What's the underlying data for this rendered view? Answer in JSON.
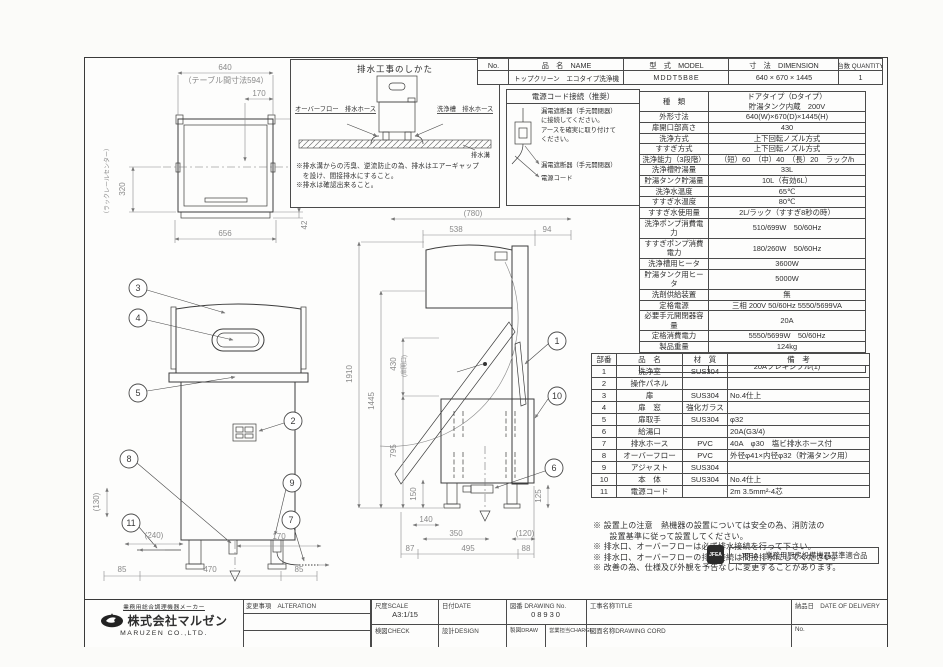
{
  "title_strip": {
    "col_no": "No.",
    "col_name": "品　名　NAME",
    "col_model": "型　式　MODEL",
    "col_dimension": "寸　法　DIMENSION",
    "col_quantity": "台数 QUANTITY",
    "row_no": "",
    "row_name": "トップクリーン　エコタイプ洗浄機",
    "row_model": "MDDT5B8E",
    "row_dimension": "640 × 670 × 1445",
    "row_quantity": "1"
  },
  "drain_box": {
    "title": "排水工事のしかた",
    "label_overflow": "オーバーフロー　排水ホース",
    "label_washtank": "洗浄槽　排水ホース",
    "label_gutter": "排水溝",
    "notes": [
      "※排水溝からの汚臭、逆流防止の為、排水はエアーギャップ",
      "　を設け、間接排水にすること。",
      "※排水は確認出来ること。"
    ]
  },
  "power_box": {
    "title": "電源コード接続（推奨）",
    "body": "漏電遮断器（手元開閉器）\nに接続してください。\nアースを確実に取り付けて\nください。",
    "label_breaker": "漏電遮断器（手元開閉器）",
    "label_cord": "電源コード"
  },
  "spec_table": {
    "rows": [
      [
        "種　類",
        "ドアタイプ（Dタイプ）\n貯湯タンク内蔵　200V"
      ],
      [
        "外形寸法",
        "640(W)×670(D)×1445(H)"
      ],
      [
        "扉開口部高さ",
        "430"
      ],
      [
        "洗浄方式",
        "上下回転ノズル方式"
      ],
      [
        "すすぎ方式",
        "上下回転ノズル方式"
      ],
      [
        "洗浄能力（3段階）",
        "（短）60　（中）40　（長）20　ラック/h"
      ],
      [
        "洗浄槽貯湯量",
        "33L"
      ],
      [
        "貯湯タンク貯湯量",
        "10L（有効6L）"
      ],
      [
        "洗浄水温度",
        "65℃"
      ],
      [
        "すすぎ水温度",
        "80℃"
      ],
      [
        "すすぎ水使用量",
        "2L/ラック（すすぎ8秒の時）"
      ],
      [
        "洗浄ポンプ消費電力",
        "510/699W　50/60Hz"
      ],
      [
        "すすぎポンプ消費電力",
        "180/260W　50/60Hz"
      ],
      [
        "洗浄槽用ヒータ",
        "3600W"
      ],
      [
        "貯湯タンク用ヒータ",
        "5000W"
      ],
      [
        "洗剤供給装置",
        "無"
      ],
      [
        "定格電源",
        "三相 200V 50/60Hz 5550/5699VA"
      ],
      [
        "必要手元開閉器容量",
        "20A"
      ],
      [
        "定格消費電力",
        "5550/5699W　50/60Hz"
      ],
      [
        "製品重量",
        "124kg"
      ],
      [
        "付属品",
        "万能ラック500×500(1)\n20Aフレキシブル(1)"
      ]
    ]
  },
  "parts_table": {
    "headers": [
      "部番",
      "品　名",
      "材　質",
      "備　考"
    ],
    "rows": [
      [
        "1",
        "洗浄室",
        "SUS304",
        ""
      ],
      [
        "2",
        "操作パネル",
        "",
        ""
      ],
      [
        "3",
        "扉",
        "SUS304",
        "No.4仕上"
      ],
      [
        "4",
        "扉　窓",
        "強化ガラス",
        ""
      ],
      [
        "5",
        "扉取手",
        "SUS304",
        "φ32"
      ],
      [
        "6",
        "給湯口",
        "",
        "20A(G3/4)"
      ],
      [
        "7",
        "排水ホース",
        "PVC",
        "40A　φ30　塩ビ排水ホース付"
      ],
      [
        "8",
        "オーバーフロー",
        "PVC",
        "外径φ41×内径φ32（貯湯タンク用）"
      ],
      [
        "9",
        "アジャスト",
        "SUS304",
        ""
      ],
      [
        "10",
        "本　体",
        "SUS304",
        "No.4仕上"
      ],
      [
        "11",
        "電源コード",
        "",
        "2m 3.5mm²-4芯"
      ]
    ]
  },
  "notes": [
    "※ 設置上の注意　熱機器の設置については安全の為、消防法の",
    "　　設置基準に従って設置してください。",
    "※ 排水口、オーバーフローは必ず排水接続を行って下さい。",
    "※ 排水口、オーバーフローの排水接続は間接排水にしてください。",
    "※ 改善の為、仕様及び外観を予告なしに変更することがあります。"
  ],
  "jfea": {
    "seal": "JFEA",
    "label": "JFEA　業務用厨房設備機器基準適合品"
  },
  "title_block": {
    "maker_tagline": "業務用総合調理機器メーカー",
    "company_jp": "株式会社マルゼン",
    "company_en": "MARUZEN CO.,LTD.",
    "alteration": "変更事項　ALTERATION",
    "scale_label": "尺度SCALE",
    "scale_value": "A3:1/15",
    "date_label": "日付DATE",
    "drawing_no_label": "図番 DRAWING No.",
    "drawing_no_value": "08930",
    "check_label": "検図CHECK",
    "design_label": "設計DESIGN",
    "draw_label": "製図DRAW",
    "charge_label": "営業担当CHARGE",
    "title_label": "工事名称TITLE",
    "delivery_label": "納品日　DATE OF DELIVERY",
    "drawing_cord_label": "図面名称DRAWING CORD",
    "no_label": "No."
  },
  "top_view": {
    "dim_640": "640",
    "dim_table": "（テーブル間寸法594）",
    "dim_170": "170",
    "dim_670": "670",
    "dim_42": "42",
    "dim_656": "656",
    "dim_320": "320",
    "label_rackrail": "（ラックレールセンター）"
  },
  "front_view": {
    "b3": "3",
    "b4": "4",
    "b5": "5",
    "b2": "2",
    "b8": "8",
    "b11": "11",
    "b9": "9",
    "b7": "7",
    "dim_130": "(130)",
    "dim_240": "(240)",
    "dim_170": "170",
    "dim_85l": "85",
    "dim_470": "470",
    "dim_85r": "85"
  },
  "side_view": {
    "b1": "1",
    "b10": "10",
    "b6": "6",
    "dim_780": "(780)",
    "dim_538": "538",
    "dim_94": "94",
    "dim_1910": "1910",
    "dim_1445": "1445",
    "dim_430": "430",
    "label_door": "(扉開口)",
    "dim_795": "795",
    "dim_150": "150",
    "dim_125": "125",
    "dim_140": "140",
    "dim_350": "350",
    "dim_120": "(120)",
    "dim_87": "87",
    "dim_495": "495",
    "dim_88": "88"
  }
}
